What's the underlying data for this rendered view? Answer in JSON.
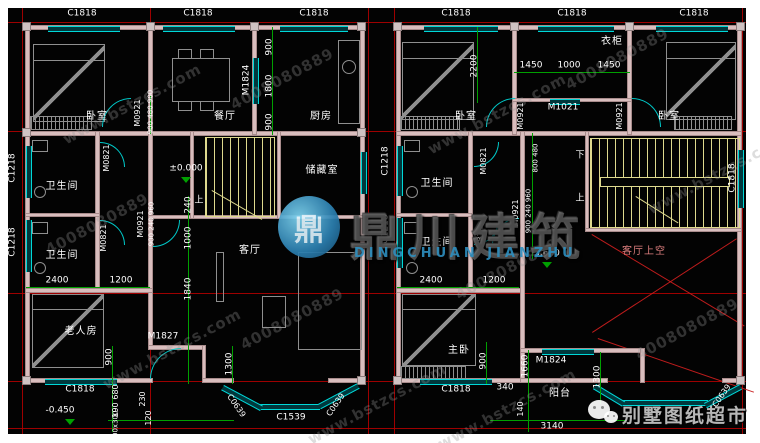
{
  "colors": {
    "bg": "#030303",
    "frame": "#ffffff",
    "wall": "#d9bebe",
    "window": "#00d8d8",
    "dim_line": "#00a000",
    "grid": "#af0000",
    "stair": "#ded98e",
    "text": "#ffffff",
    "brand_blue": "#2e8fc0",
    "void_text": "#e08080"
  },
  "watermark": {
    "tile_a": "www.bstzcs.com",
    "tile_b": "4008080889",
    "logo_char": "鼎",
    "brand_cn": "鼎川建筑",
    "brand_en": "DINGCHUAN JIANZHU",
    "footer_brand": "别墅图纸超市"
  },
  "left": {
    "win_top1": "C1818",
    "win_top2": "C1818",
    "win_top3": "C1818",
    "win_left1": "C1218",
    "win_left2": "C1218",
    "win_bottom": "C1818",
    "bay_left": "C0639",
    "bay_center": "C1539",
    "bay_right": "C0639",
    "door_kitchen": "M1824",
    "door_bed": "M0921",
    "door_bath1": "M0821",
    "door_bath2": "M0821",
    "door_hall": "M0921",
    "door_entry": "M1827",
    "room_bed": "卧室",
    "room_dining": "餐厅",
    "room_kitchen": "厨房",
    "room_bath1": "卫生间",
    "room_bath2": "卫生间",
    "room_storage": "储藏室",
    "room_living": "客厅",
    "room_elder": "老人房",
    "stair_up": "上",
    "lvl_zero": "±0.000",
    "lvl_entry": "-0.450",
    "d900a": "900",
    "d1800": "1800",
    "d900b": "900",
    "chain_top": "900 480 900",
    "chain_mid": "900 240 960",
    "d240": "240",
    "d1000": "1000",
    "d1840": "1840",
    "d2400": "2400",
    "d1200": "1200",
    "d900c": "900",
    "d680": "680",
    "d190": "190",
    "dcol": "300x300",
    "d230": "230",
    "d120": "120",
    "d1300": "1300"
  },
  "right": {
    "win_top1": "C1818",
    "win_top2": "C1818",
    "win_top3": "C1818",
    "win_left1": "C1218",
    "win_left2": "C1218",
    "win_stair": "C1818",
    "win_bottom": "C1818",
    "bay_right": "C0639",
    "door_ward": "M1021",
    "door_bed1": "M0921",
    "door_bed2": "M0921",
    "door_bath1": "M0821",
    "door_bath2": "M0821",
    "door_hall": "M0921",
    "door_balcony": "M1824",
    "room_bed1": "卧室",
    "room_ward": "衣柜",
    "room_bed2": "卧室",
    "room_bath1": "卫生间",
    "room_bath2": "卫生间",
    "room_master": "主卧",
    "room_balcony": "阳台",
    "room_void": "客厅上空",
    "stair_up": "上",
    "stair_down": "下",
    "lvl": "3.600",
    "d2200": "2200",
    "d1450a": "1450",
    "d1000": "1000",
    "d1450b": "1450",
    "chain_top": "800 480",
    "chain_mid": "900 240 960",
    "d2400": "2400",
    "d1200": "1200",
    "d900": "900",
    "d340": "340",
    "d1660": "1660",
    "d140": "140",
    "d3140": "3140",
    "d1300": "1300"
  }
}
